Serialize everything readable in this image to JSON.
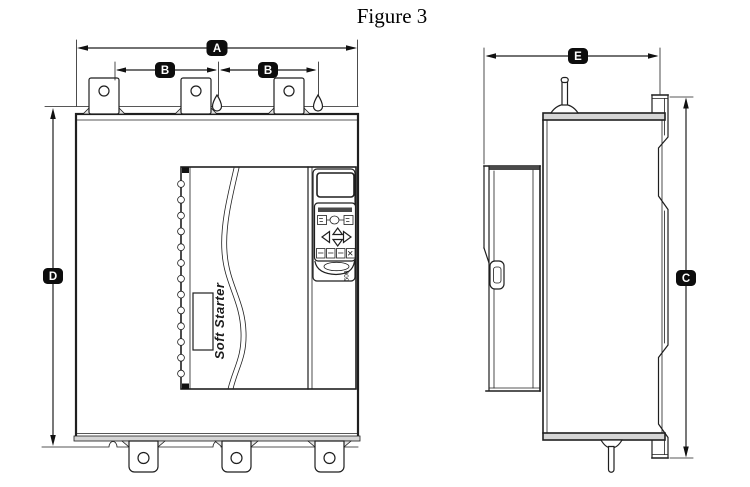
{
  "title": "Figure 3",
  "labels": {
    "A": "A",
    "B_left": "B",
    "B_right": "B",
    "C": "C",
    "D": "D",
    "E": "E"
  },
  "device": {
    "brand": "Soft Starter",
    "model": "500"
  },
  "icons": {
    "keypad_left": "left-arrow",
    "keypad_up": "up-arrow",
    "keypad_down": "down-arrow",
    "keypad_right": "right-arrow"
  },
  "colors": {
    "line": "#1f1f1f",
    "label_bg": "#0d0d0d",
    "label_text": "#ffffff"
  }
}
